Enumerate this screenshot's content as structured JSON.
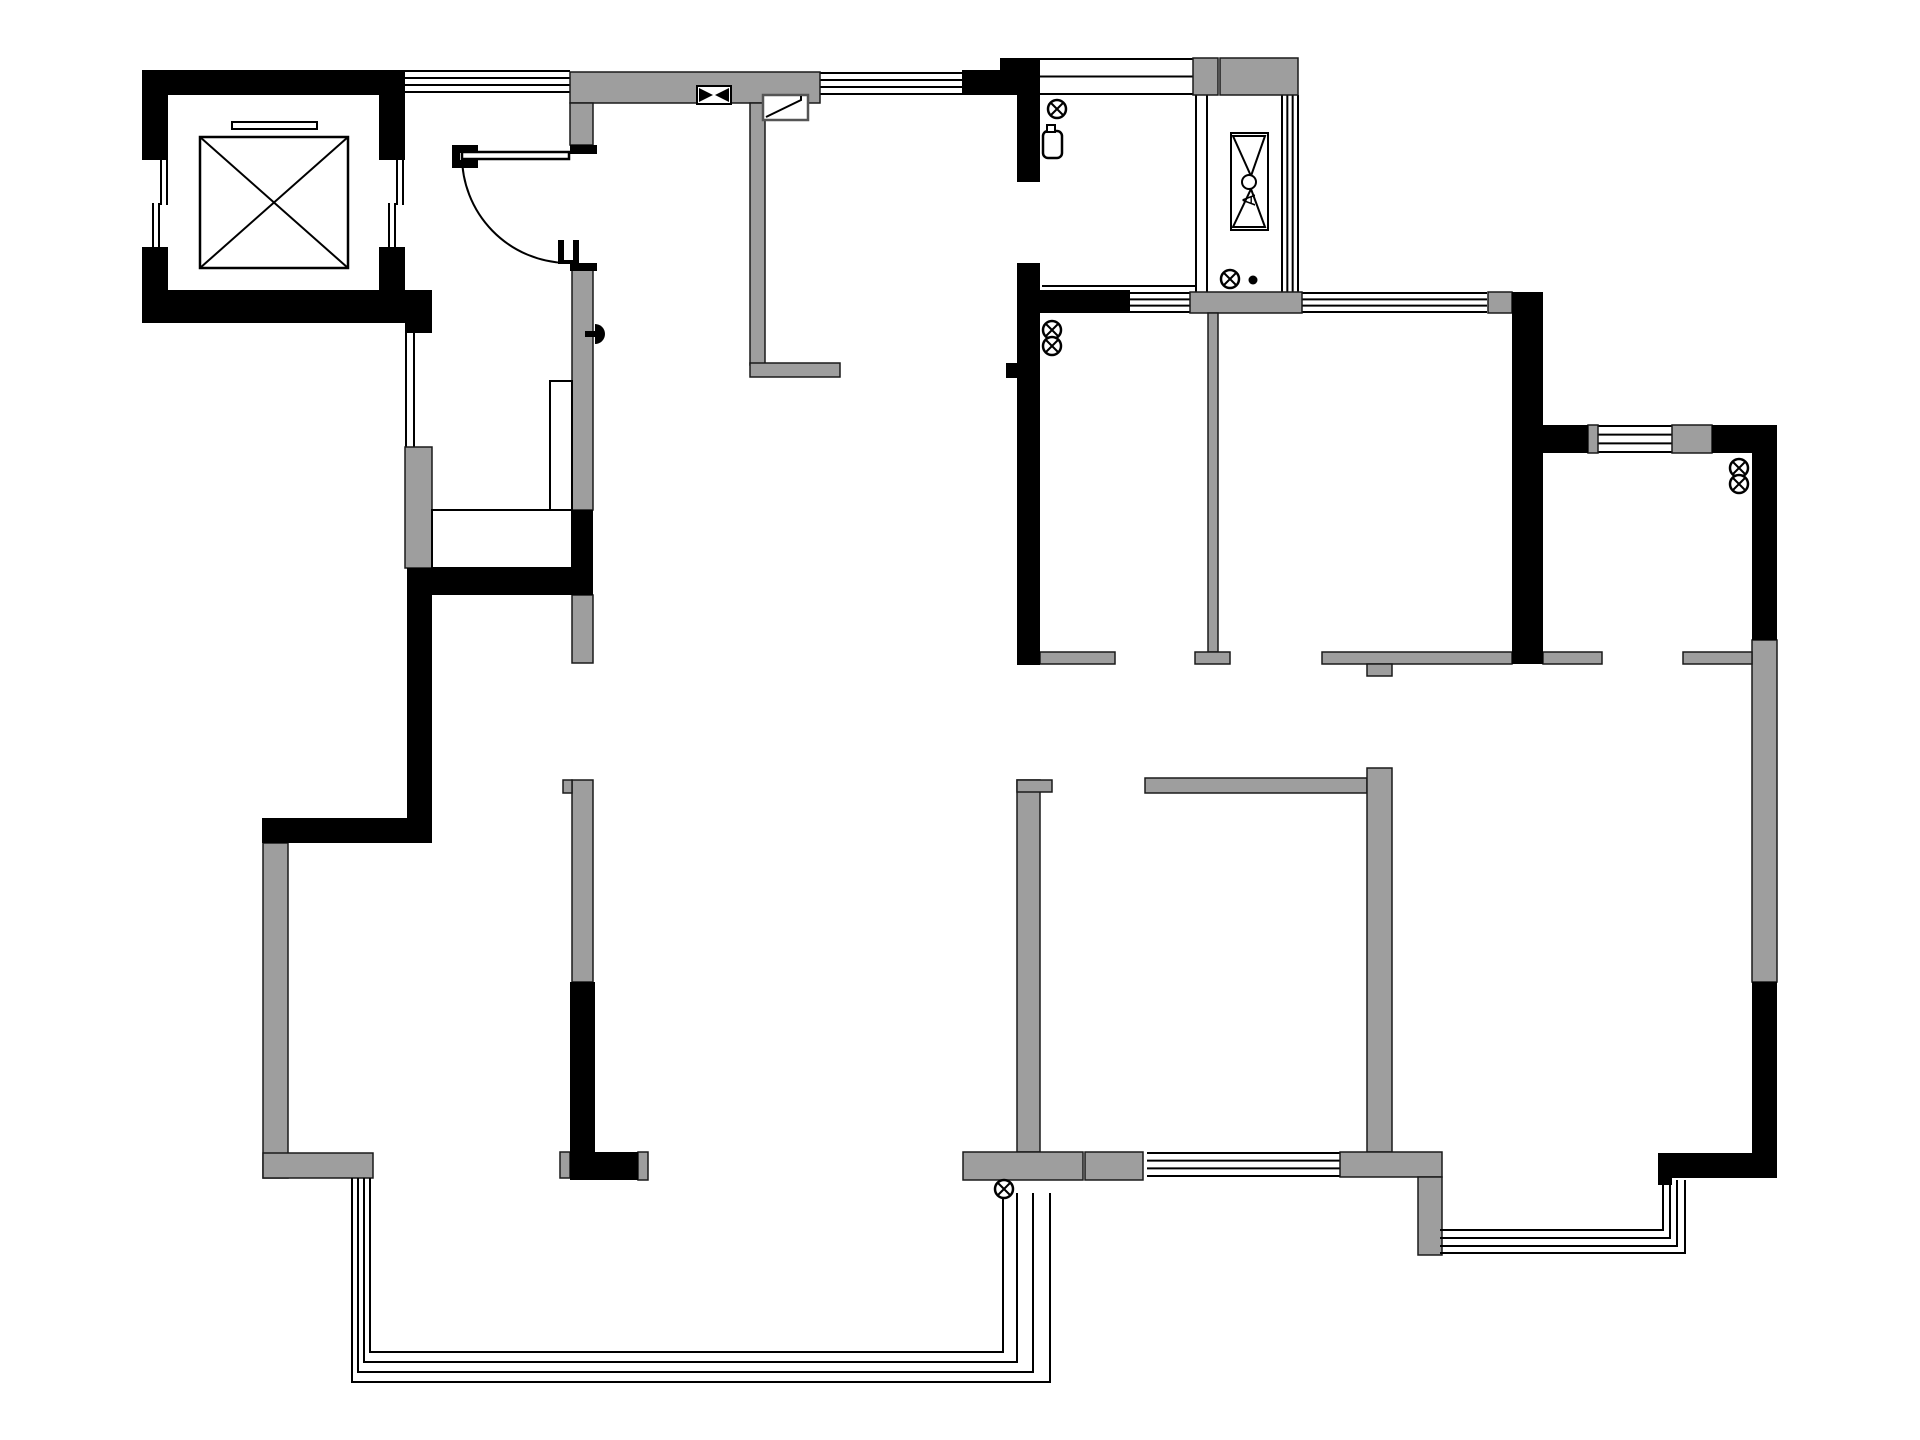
{
  "title": "apartment-floor-plan",
  "canvas": {
    "width": 1920,
    "height": 1440,
    "background": "#ffffff"
  },
  "colors": {
    "wall_black": "#000000",
    "wall_gray": "#9e9e9e",
    "wall_gray_stroke": "#1a1a1a",
    "line": "#000000",
    "flue_stroke": "#555555",
    "white": "#ffffff"
  },
  "floor_plan": {
    "black_walls": [
      [
        142,
        70,
        263,
        25
      ],
      [
        142,
        95,
        26,
        65
      ],
      [
        142,
        247,
        26,
        43
      ],
      [
        379,
        95,
        26,
        65
      ],
      [
        379,
        247,
        26,
        43
      ],
      [
        142,
        290,
        263,
        33
      ],
      [
        405,
        290,
        27,
        43
      ],
      [
        962,
        70,
        55,
        25
      ],
      [
        1000,
        58,
        40,
        37
      ],
      [
        1017,
        95,
        23,
        87
      ],
      [
        1017,
        263,
        23,
        402
      ],
      [
        1040,
        290,
        90,
        23
      ],
      [
        1006,
        363,
        11,
        15
      ],
      [
        407,
        568,
        25,
        275
      ],
      [
        262,
        818,
        170,
        25
      ],
      [
        432,
        568,
        158,
        27
      ],
      [
        572,
        510,
        21,
        85
      ],
      [
        570,
        982,
        25,
        198
      ],
      [
        570,
        1152,
        68,
        28
      ],
      [
        1512,
        292,
        31,
        372
      ],
      [
        1543,
        425,
        45,
        28
      ],
      [
        1712,
        425,
        65,
        28
      ],
      [
        1752,
        453,
        25,
        187
      ],
      [
        1752,
        982,
        25,
        196
      ],
      [
        1667,
        1153,
        110,
        25
      ],
      [
        1658,
        1153,
        14,
        32
      ],
      [
        570,
        145,
        27,
        9
      ],
      [
        570,
        263,
        27,
        8
      ]
    ],
    "gray_walls": [
      [
        570,
        72,
        250,
        31
      ],
      [
        570,
        103,
        23,
        42
      ],
      [
        750,
        103,
        15,
        262
      ],
      [
        750,
        363,
        90,
        14
      ],
      [
        572,
        267,
        21,
        243
      ],
      [
        572,
        595,
        21,
        68
      ],
      [
        572,
        780,
        21,
        202
      ],
      [
        563,
        780,
        9,
        13
      ],
      [
        405,
        447,
        27,
        121
      ],
      [
        1190,
        292,
        112,
        21
      ],
      [
        1208,
        313,
        10,
        339
      ],
      [
        1195,
        652,
        35,
        12
      ],
      [
        1193,
        58,
        25,
        37
      ],
      [
        1220,
        58,
        78,
        37
      ],
      [
        1488,
        292,
        24,
        21
      ],
      [
        1588,
        425,
        10,
        28
      ],
      [
        1672,
        425,
        40,
        28
      ],
      [
        1752,
        640,
        25,
        342
      ],
      [
        1683,
        652,
        69,
        12
      ],
      [
        1322,
        652,
        190,
        12
      ],
      [
        1543,
        652,
        59,
        12
      ],
      [
        1367,
        664,
        25,
        12
      ],
      [
        1017,
        780,
        23,
        372
      ],
      [
        1017,
        780,
        35,
        12
      ],
      [
        1145,
        778,
        222,
        15
      ],
      [
        1367,
        768,
        25,
        384
      ],
      [
        963,
        1152,
        120,
        28
      ],
      [
        1085,
        1152,
        58,
        28
      ],
      [
        1340,
        1152,
        102,
        25
      ],
      [
        1418,
        1177,
        24,
        78
      ],
      [
        263,
        843,
        25,
        335
      ],
      [
        263,
        1153,
        110,
        25
      ],
      [
        560,
        1152,
        10,
        26
      ],
      [
        638,
        1152,
        10,
        28
      ],
      [
        1040,
        652,
        75,
        12
      ]
    ],
    "windows": [
      {
        "x": 405,
        "y": 70,
        "w": 165,
        "h": 23,
        "orient": "h",
        "lines": 4
      },
      {
        "x": 820,
        "y": 72,
        "w": 142,
        "h": 23,
        "orient": "h",
        "lines": 4
      },
      {
        "x": 1040,
        "y": 58,
        "w": 153,
        "h": 37,
        "orient": "h",
        "lines": 3
      },
      {
        "x": 1195,
        "y": 95,
        "w": 13,
        "h": 197,
        "orient": "v",
        "lines": 2
      },
      {
        "x": 1281,
        "y": 95,
        "w": 18,
        "h": 197,
        "orient": "v",
        "lines": 4
      },
      {
        "x": 1130,
        "y": 292,
        "w": 60,
        "h": 21,
        "orient": "h",
        "lines": 4
      },
      {
        "x": 1302,
        "y": 292,
        "w": 185,
        "h": 21,
        "orient": "h",
        "lines": 4
      },
      {
        "x": 1598,
        "y": 425,
        "w": 74,
        "h": 28,
        "orient": "h",
        "lines": 4
      },
      {
        "x": 1147,
        "y": 1152,
        "w": 193,
        "h": 25,
        "orient": "h",
        "lines": 4
      },
      {
        "x": 405,
        "y": 333,
        "w": 10,
        "h": 114,
        "orient": "v",
        "lines": 2
      },
      {
        "x": 396,
        "y": 160,
        "w": 8,
        "h": 45,
        "orient": "v",
        "lines": 2
      },
      {
        "x": 388,
        "y": 203,
        "w": 8,
        "h": 44,
        "orient": "v",
        "lines": 2
      },
      {
        "x": 160,
        "y": 160,
        "w": 8,
        "h": 45,
        "orient": "v",
        "lines": 2
      },
      {
        "x": 152,
        "y": 203,
        "w": 8,
        "h": 44,
        "orient": "v",
        "lines": 2
      }
    ],
    "white_rects": [
      [
        550,
        381,
        22,
        129
      ],
      [
        432,
        510,
        140,
        58
      ]
    ],
    "thin_lines": [
      [
        1042,
        286,
        1195,
        286
      ]
    ],
    "balcony_railings": [
      "M352,1178 V1382 H1050 V1193",
      "M358,1178 V1372 H1033 V1193",
      "M364,1178 V1362 H1017 V1193",
      "M370,1178 V1352 H1003 V1193"
    ],
    "bay_window_railings": [
      "M1440,1253 H1685 V1180",
      "M1440,1246 H1677 V1180",
      "M1440,1238 H1670 V1180",
      "M1440,1230 H1663 V1180"
    ],
    "entry_door": {
      "leaf": [
        462,
        152,
        107,
        7
      ],
      "arc": "M462,156 A107 107 0 0 0 566 263",
      "hinge_blocks": [
        [
          452,
          145,
          26,
          8
        ],
        [
          452,
          160,
          26,
          8
        ],
        [
          452,
          145,
          8,
          23
        ]
      ],
      "jamb_blocks": [
        [
          558,
          240,
          6,
          24
        ],
        [
          573,
          240,
          6,
          24
        ],
        [
          558,
          260,
          21,
          4
        ]
      ]
    },
    "elevator": {
      "car_box": [
        200,
        137,
        148,
        131
      ],
      "door_bar": [
        232,
        122,
        85,
        7
      ]
    },
    "symbols": {
      "crossed_circles": [
        [
          1057,
          109
        ],
        [
          1230,
          279
        ],
        [
          1052,
          330
        ],
        [
          1052,
          346
        ],
        [
          1739,
          468
        ],
        [
          1739,
          484
        ],
        [
          1004,
          1189
        ]
      ],
      "crossed_circle_radius": 9,
      "dots": [
        [
          1253,
          280
        ]
      ],
      "dot_radius": 4.5,
      "door_handle": {
        "semicircle": "M595,324 A10,10 0 0 1 595,344 Z",
        "stem": [
          585,
          331,
          10,
          6
        ]
      },
      "vent_valve": {
        "rect": [
          697,
          86,
          34,
          18
        ],
        "triangles": [
          [
            699,
            88,
            699,
            102,
            713,
            95
          ],
          [
            729,
            88,
            729,
            102,
            715,
            95
          ]
        ]
      },
      "flue": {
        "rect": [
          763,
          95,
          45,
          25
        ],
        "flap": "M766,117 L801,100 L801,96"
      },
      "air_unit": {
        "rect": [
          1231,
          133,
          37,
          97
        ],
        "triangle_top": [
          1233,
          136,
          1265,
          136,
          1251,
          176
        ],
        "triangle_bottom": [
          1233,
          227,
          1265,
          227,
          1251,
          189
        ],
        "circle": [
          1249,
          182,
          7
        ],
        "label": "A",
        "label_pos": [
          1249,
          200
        ]
      },
      "wall_fixture": {
        "body": [
          1043,
          131,
          19,
          27
        ],
        "nub": [
          1047,
          125,
          8,
          7
        ]
      }
    }
  }
}
